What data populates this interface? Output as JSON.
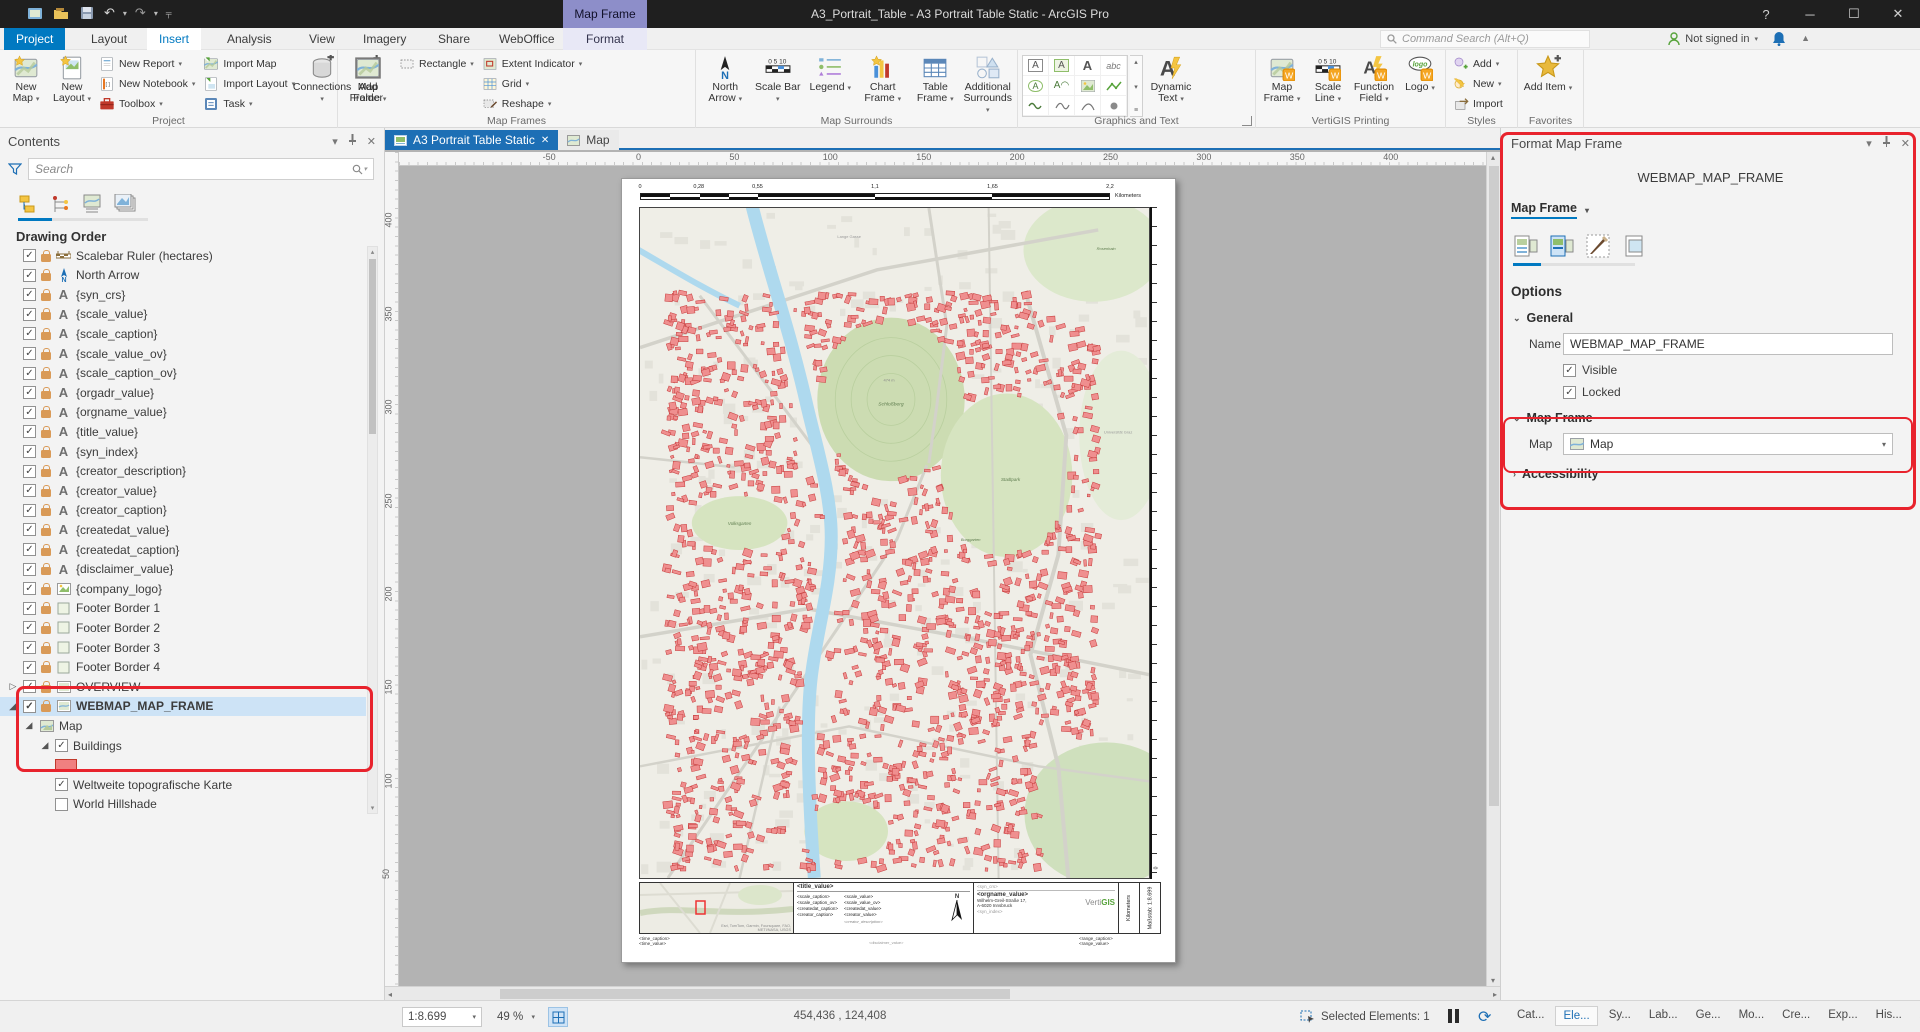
{
  "window": {
    "title": "A3_Portrait_Table - A3 Portrait Table Static - ArcGIS Pro",
    "contextual_group": "Map Frame",
    "help": "?",
    "search_placeholder": "Command Search (Alt+Q)",
    "sign_in": "Not signed in"
  },
  "ribbon_tabs": [
    {
      "label": "Project",
      "style": "backstage"
    },
    {
      "label": "Layout"
    },
    {
      "label": "Insert",
      "active": true
    },
    {
      "label": "Analysis"
    },
    {
      "label": "View"
    },
    {
      "label": "Imagery"
    },
    {
      "label": "Share"
    },
    {
      "label": "WebOffice"
    },
    {
      "label": "Format",
      "contextual": true
    }
  ],
  "ribbon_groups": [
    {
      "label": "Project",
      "items": [
        {
          "kind": "big",
          "icon": "new-map",
          "label": "New Map",
          "caret": true
        },
        {
          "kind": "big",
          "icon": "new-layout",
          "label": "New Layout",
          "caret": true
        },
        {
          "kind": "col",
          "items": [
            {
              "icon": "new-report",
              "label": "New Report",
              "caret": true
            },
            {
              "icon": "new-notebook",
              "label": "New Notebook",
              "caret": true
            },
            {
              "icon": "toolbox",
              "label": "Toolbox",
              "caret": true
            }
          ]
        },
        {
          "kind": "col",
          "items": [
            {
              "icon": "import-map",
              "label": "Import Map"
            },
            {
              "icon": "import-layout",
              "label": "Import Layout",
              "caret": true
            },
            {
              "icon": "task",
              "label": "Task",
              "caret": true
            }
          ]
        },
        {
          "kind": "big",
          "icon": "connections",
          "label": "Connections",
          "caret": true
        },
        {
          "kind": "big",
          "icon": "add-folder",
          "label": "Add Folder"
        }
      ]
    },
    {
      "label": "Map Frames",
      "items": [
        {
          "kind": "big",
          "icon": "map-frame",
          "label": "Map Frame",
          "caret": true
        },
        {
          "kind": "col",
          "items": [
            {
              "icon": "rectangle",
              "label": "Rectangle",
              "caret": true
            }
          ]
        },
        {
          "kind": "col",
          "items": [
            {
              "icon": "extent",
              "label": "Extent Indicator",
              "caret": true
            },
            {
              "icon": "grid",
              "label": "Grid",
              "caret": true
            },
            {
              "icon": "reshape",
              "label": "Reshape",
              "caret": true
            }
          ]
        }
      ]
    },
    {
      "label": "Map Surrounds",
      "items": [
        {
          "kind": "big",
          "icon": "north-arrow",
          "label": "North Arrow",
          "caret": true
        },
        {
          "kind": "big",
          "icon": "scale-bar",
          "label": "Scale Bar",
          "caret": true
        },
        {
          "kind": "big",
          "icon": "legend",
          "label": "Legend",
          "caret": true
        },
        {
          "kind": "big",
          "icon": "chart-frame",
          "label": "Chart Frame",
          "caret": true
        },
        {
          "kind": "big",
          "icon": "table-frame",
          "label": "Table Frame",
          "caret": true
        },
        {
          "kind": "big",
          "icon": "surrounds",
          "label": "Additional Surrounds",
          "caret": true
        }
      ]
    },
    {
      "label": "Graphics and Text",
      "gallery": true,
      "launcher": true,
      "items": [
        {
          "kind": "big",
          "icon": "dynamic-text",
          "label": "Dynamic Text",
          "caret": true
        }
      ]
    },
    {
      "label": "VertiGIS Printing",
      "items": [
        {
          "kind": "big",
          "icon": "vg-map-frame",
          "label": "Map Frame",
          "caret": true
        },
        {
          "kind": "big",
          "icon": "vg-scale-line",
          "label": "Scale Line",
          "caret": true
        },
        {
          "kind": "big",
          "icon": "vg-function-field",
          "label": "Function Field",
          "caret": true
        },
        {
          "kind": "big",
          "icon": "vg-logo",
          "label": "Logo",
          "caret": true
        }
      ]
    },
    {
      "label": "Styles",
      "items": [
        {
          "kind": "col",
          "items": [
            {
              "icon": "style-add",
              "label": "Add",
              "caret": true
            },
            {
              "icon": "style-new",
              "label": "New",
              "caret": true
            },
            {
              "icon": "style-import",
              "label": "Import"
            }
          ]
        }
      ]
    },
    {
      "label": "Favorites",
      "items": [
        {
          "kind": "big",
          "icon": "add-item",
          "label": "Add Item",
          "caret": true
        }
      ]
    }
  ],
  "gallery_cells": [
    "boxed-a",
    "map-a",
    "plain-a",
    "curved-text-abc",
    "circle-a",
    "callout-a",
    "picture",
    "line-green",
    "wave",
    "squiggle",
    "arc",
    "point"
  ],
  "contents": {
    "title": "Contents",
    "search_placeholder": "Search",
    "heading": "Drawing Order",
    "items": [
      {
        "depth": 1,
        "check": true,
        "lock": true,
        "icon": "scalebar",
        "label": "Scalebar Ruler (hectares)"
      },
      {
        "depth": 1,
        "check": true,
        "lock": true,
        "icon": "northarrow",
        "label": "North Arrow"
      },
      {
        "depth": 1,
        "check": true,
        "lock": true,
        "icon": "text",
        "label": "{syn_crs}"
      },
      {
        "depth": 1,
        "check": true,
        "lock": true,
        "icon": "text",
        "label": "{scale_value}"
      },
      {
        "depth": 1,
        "check": true,
        "lock": true,
        "icon": "text",
        "label": "{scale_caption}"
      },
      {
        "depth": 1,
        "check": true,
        "lock": true,
        "icon": "text",
        "label": "{scale_value_ov}"
      },
      {
        "depth": 1,
        "check": true,
        "lock": true,
        "icon": "text",
        "label": "{scale_caption_ov}"
      },
      {
        "depth": 1,
        "check": true,
        "lock": true,
        "icon": "text",
        "label": "{orgadr_value}"
      },
      {
        "depth": 1,
        "check": true,
        "lock": true,
        "icon": "text",
        "label": "{orgname_value}"
      },
      {
        "depth": 1,
        "check": true,
        "lock": true,
        "icon": "text",
        "label": "{title_value}"
      },
      {
        "depth": 1,
        "check": true,
        "lock": true,
        "icon": "text",
        "label": "{syn_index}"
      },
      {
        "depth": 1,
        "check": true,
        "lock": true,
        "icon": "text",
        "label": "{creator_description}"
      },
      {
        "depth": 1,
        "check": true,
        "lock": true,
        "icon": "text",
        "label": "{creator_value}"
      },
      {
        "depth": 1,
        "check": true,
        "lock": true,
        "icon": "text",
        "label": "{creator_caption}"
      },
      {
        "depth": 1,
        "check": true,
        "lock": true,
        "icon": "text",
        "label": "{createdat_value}"
      },
      {
        "depth": 1,
        "check": true,
        "lock": true,
        "icon": "text",
        "label": "{createdat_caption}"
      },
      {
        "depth": 1,
        "check": true,
        "lock": true,
        "icon": "text",
        "label": "{disclaimer_value}"
      },
      {
        "depth": 1,
        "check": true,
        "lock": true,
        "icon": "picture",
        "label": "{company_logo}"
      },
      {
        "depth": 1,
        "check": true,
        "lock": true,
        "icon": "rect",
        "label": "Footer Border 1"
      },
      {
        "depth": 1,
        "check": true,
        "lock": true,
        "icon": "rect",
        "label": "Footer Border 2"
      },
      {
        "depth": 1,
        "check": true,
        "lock": true,
        "icon": "rect",
        "label": "Footer Border 3"
      },
      {
        "depth": 1,
        "check": true,
        "lock": true,
        "icon": "rect",
        "label": "Footer Border 4"
      },
      {
        "depth": 1,
        "check": true,
        "lock": true,
        "icon": "mapframe",
        "label": "OVERVIEW",
        "expand": "collapsed"
      },
      {
        "depth": 1,
        "check": true,
        "lock": true,
        "icon": "mapframe",
        "label": "WEBMAP_MAP_FRAME",
        "expand": "expanded",
        "selected": true,
        "bold": true
      },
      {
        "depth": 2,
        "icon": "map",
        "label": "Map",
        "expand": "expanded"
      },
      {
        "depth": 3,
        "check": true,
        "label": "Buildings",
        "expand": "expanded"
      },
      {
        "depth": 3,
        "swatch": true,
        "label": ""
      },
      {
        "depth": 3,
        "check": true,
        "label": "Weltweite topografische Karte"
      },
      {
        "depth": 3,
        "check": false,
        "label": "World Hillshade"
      }
    ]
  },
  "view": {
    "tabs": [
      {
        "label": "A3 Portrait Table Static",
        "active": true,
        "closable": true
      },
      {
        "label": "Map"
      }
    ],
    "h_ruler": [
      -50,
      0,
      50,
      100,
      150,
      200,
      250,
      300,
      350,
      400
    ],
    "v_ruler": [
      400,
      350,
      300,
      250,
      200,
      150,
      100,
      50
    ]
  },
  "page": {
    "scalebar": {
      "labels": [
        "0",
        "0,28",
        "0,55",
        "1,1",
        "1,65",
        "2,2"
      ],
      "fractions": [
        0,
        0.125,
        0.25,
        0.5,
        0.75,
        1.0
      ],
      "unit": "Kilometers"
    },
    "map_labels": [
      "Schloßberg",
      "474 m",
      "Stadtpark",
      "Volksgarten",
      "Burggarten",
      "Rosenhain",
      "Universität Graz",
      "Lange Gasse"
    ],
    "ruler_zero": "0",
    "footer": {
      "attribution": "Esri, TomTom, Garmin, Foursquare, FAO, METI/NASA, USGS",
      "title": "<title_value>",
      "captions": [
        "<scale_caption>",
        "<scale_caption_ov>",
        "<createdat_caption>",
        "<creator_caption>"
      ],
      "values": [
        "<scale_value>",
        "<scale_value_ov>",
        "<createdat_value>",
        "<creator_value>"
      ],
      "creator_description": "<creator_description>",
      "north": "N",
      "syn_crs": "<syn_crs>",
      "orgname": "<orgname_value>",
      "address1": "Wilhelm-Greil-Straße 17,",
      "address2": "A-6020 Innsbruck",
      "syn_index": "<syn_index>",
      "logo_gray": "Verti",
      "logo_green": "GIS",
      "kilometers": "Kilometers",
      "masstab": "Maßstab: 1:8.699",
      "time_caption": "<time_caption>",
      "time_value": "<time_value>",
      "disclaimer": "<disclaimer_value>",
      "range_caption": "<range_caption>",
      "range_value": "<range_value>"
    }
  },
  "format_panel": {
    "title": "Format Map Frame",
    "element_name": "WEBMAP_MAP_FRAME",
    "selector": "Map Frame",
    "options": "Options",
    "general": "General",
    "name_label": "Name",
    "name_value": "WEBMAP_MAP_FRAME",
    "visible": "Visible",
    "locked": "Locked",
    "map_frame_section": "Map Frame",
    "map_label": "Map",
    "map_value": "Map",
    "accessibility": "Accessibility"
  },
  "status": {
    "scale": "1:8.699",
    "zoom": "49 %",
    "coords": "454,436 , 124,408",
    "selected_label": "Selected Elements: 1"
  },
  "panel_tabs": [
    {
      "label": "Cat..."
    },
    {
      "label": "Ele...",
      "active": true
    },
    {
      "label": "Sy..."
    },
    {
      "label": "Lab..."
    },
    {
      "label": "Ge..."
    },
    {
      "label": "Mo..."
    },
    {
      "label": "Cre..."
    },
    {
      "label": "Exp..."
    },
    {
      "label": "His..."
    },
    {
      "label": "Attr..."
    }
  ],
  "colors": {
    "accent_blue": "#0079c1",
    "view_blue": "#1d6fb5",
    "selection": "#cde3f6",
    "annotation_red": "#e8232d",
    "building_fill": "#ef8f8f",
    "building_stroke": "#c63b3b",
    "river": "#aed9ee",
    "park": "#d6e4c0",
    "vertigis_green": "#57a33b",
    "badge_orange": "#f5a623"
  }
}
